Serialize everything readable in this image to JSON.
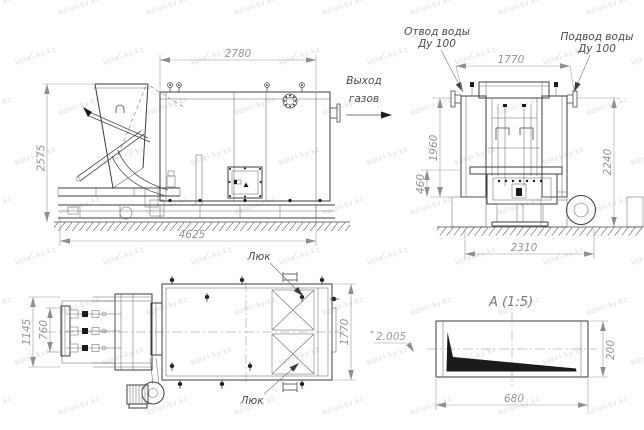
{
  "watermark": {
    "text": "kotel-kv.kz"
  },
  "front_view": {
    "dim_width_top": "2780",
    "dim_height_left": "2575",
    "dim_length_bottom": "4625",
    "gas_outlet_label_line1": "Выход",
    "gas_outlet_label_line2": "газов"
  },
  "side_view": {
    "water_outlet_line1": "Отвод воды",
    "water_outlet_line2": "Ду 100",
    "water_inlet_line1": "Подвод воды",
    "water_inlet_line2": "Ду 100",
    "dim_width_top": "1770",
    "dim_height_left": "1960",
    "dim_height_left_small": "460",
    "dim_height_right": "2240",
    "dim_width_bottom": "2310"
  },
  "top_view": {
    "hatch_label_top": "Люк",
    "hatch_label_bottom": "Люк",
    "dim_width_outer": "1145",
    "dim_width_inner": "760",
    "dim_height_right": "1770"
  },
  "detail_view": {
    "title": "А (1:5)",
    "ref_mark": "*",
    "ref_value": "2.005",
    "dim_width": "680",
    "dim_height": "200"
  }
}
